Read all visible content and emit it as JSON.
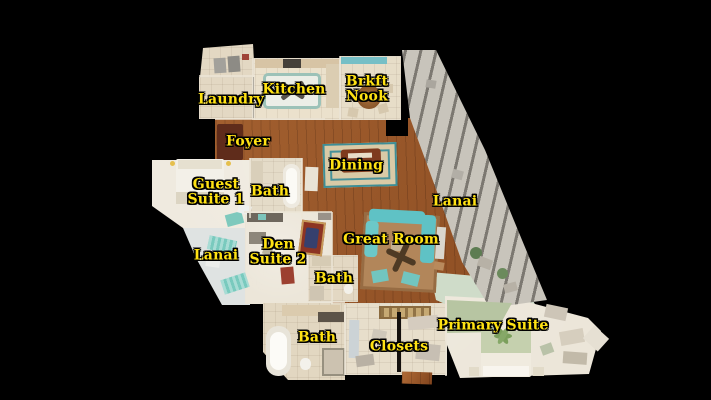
{
  "floorplan": {
    "labels": [
      {
        "id": "laundry",
        "text": "Laundry"
      },
      {
        "id": "kitchen",
        "text": "Kitchen"
      },
      {
        "id": "brkft-nook",
        "text": "Brkft\nNook"
      },
      {
        "id": "foyer",
        "text": "Foyer"
      },
      {
        "id": "dining",
        "text": "Dining"
      },
      {
        "id": "guest-suite-1",
        "text": "Guest\nSuite 1"
      },
      {
        "id": "guest-bath",
        "text": "Bath"
      },
      {
        "id": "lanai-right",
        "text": "Lanai"
      },
      {
        "id": "great-room",
        "text": "Great Room"
      },
      {
        "id": "lanai-left",
        "text": "Lanai"
      },
      {
        "id": "den-suite-2",
        "text": "Den\nSuite 2"
      },
      {
        "id": "den-bath",
        "text": "Bath"
      },
      {
        "id": "primary-bath",
        "text": "Bath"
      },
      {
        "id": "closets",
        "text": "Closets"
      },
      {
        "id": "primary-suite",
        "text": "Primary Suite"
      }
    ]
  },
  "colors": {
    "background": "#000000",
    "label_text": "#FFE213",
    "label_outline": "#000000",
    "hardwood_floor": "#9a5527",
    "tile_floor": "#e3d8c3",
    "carpet_floor": "#ece6d9",
    "lanai_floor": "#dfe3e2",
    "screen_enclosure": "#c8c4bb",
    "sofa_teal": "#5fc2c5",
    "great_room_rug": "#b2865a",
    "dining_rug_field": "#d9caa6",
    "dining_rug_border": "#3e8e96"
  }
}
